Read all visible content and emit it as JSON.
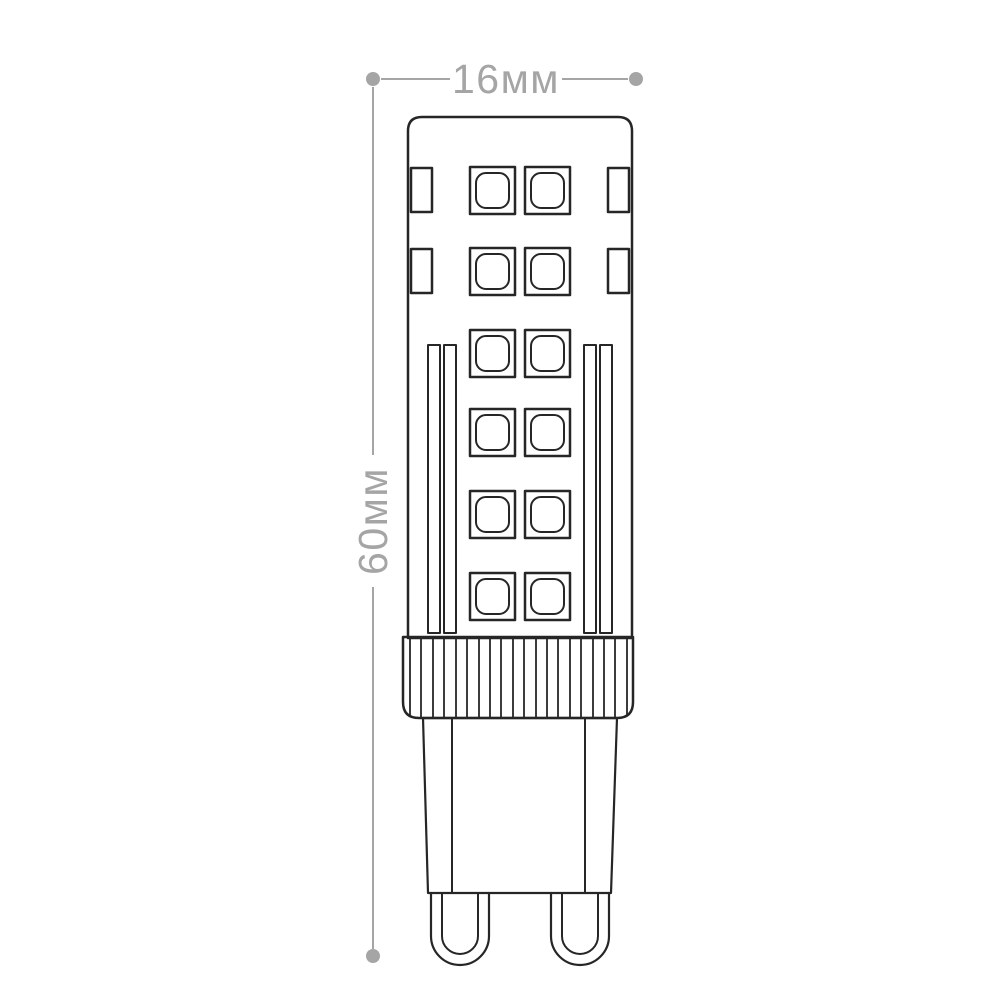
{
  "diagram": {
    "subject": "LED capsule lamp outline drawing with two-pin looped base",
    "dimensions": {
      "width": {
        "label": "16мм"
      },
      "height": {
        "label": "60мм"
      }
    },
    "colors": {
      "line": "#262626",
      "dimension": "#a5a5a5",
      "background": "#ffffff"
    },
    "structure": {
      "led_rows": 6,
      "led_columns": 2,
      "side_slots_per_side": 2,
      "heat_strips_per_side": 2,
      "collar_ribs": 20,
      "pins": 2
    }
  }
}
